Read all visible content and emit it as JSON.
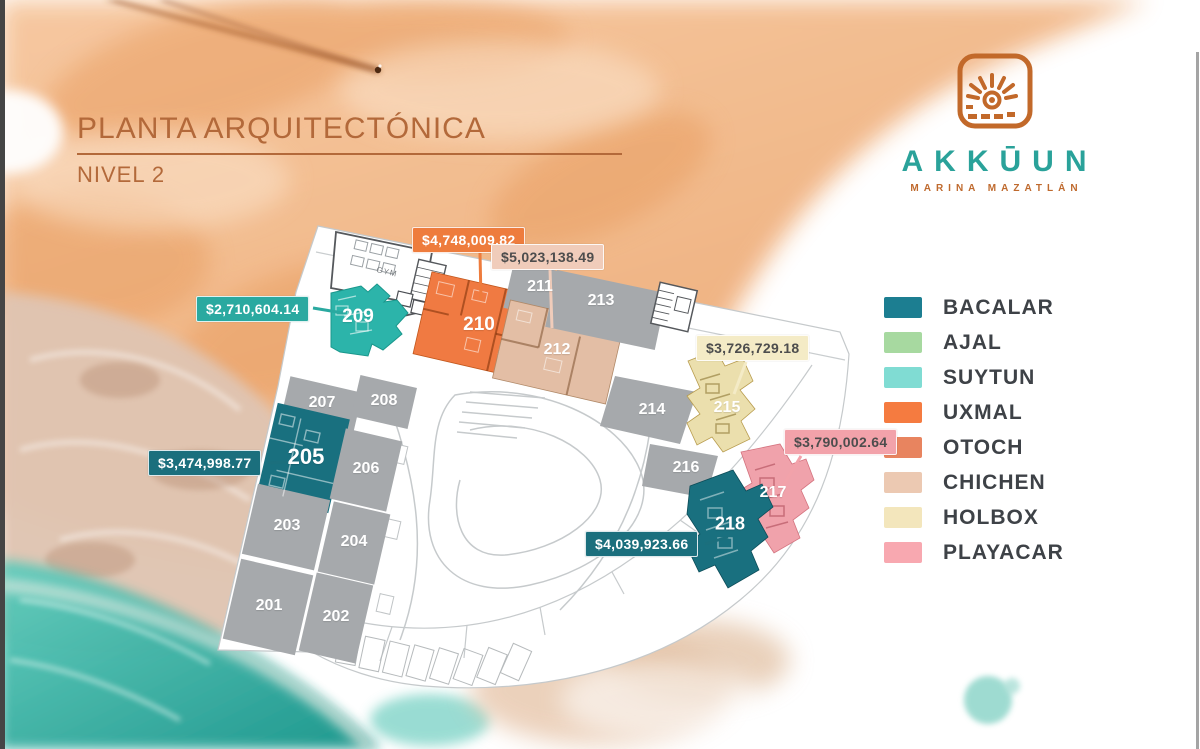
{
  "header": {
    "title": "PLANTA ARQUITECTÓNICA",
    "subtitle": "NIVEL 2"
  },
  "logo": {
    "brand": "AKKŪUN",
    "tagline": "MARINA MAZATLÁN"
  },
  "legend": {
    "items": [
      {
        "label": "BACALAR",
        "color": "#1c7e91"
      },
      {
        "label": "AJAL",
        "color": "#a7d9a0"
      },
      {
        "label": "SUYTUN",
        "color": "#80dcd3"
      },
      {
        "label": "UXMAL",
        "color": "#f57b40"
      },
      {
        "label": "OTOCH",
        "color": "#e8845f"
      },
      {
        "label": "CHICHEN",
        "color": "#ecc9b2"
      },
      {
        "label": "HOLBOX",
        "color": "#f3e6bc"
      },
      {
        "label": "PLAYACAR",
        "color": "#f8a8b0"
      }
    ]
  },
  "plan": {
    "gym_label": "GYM",
    "units": [
      {
        "number": "201",
        "color": "#a6a9ac"
      },
      {
        "number": "202",
        "color": "#a6a9ac"
      },
      {
        "number": "203",
        "color": "#a6a9ac"
      },
      {
        "number": "204",
        "color": "#a6a9ac"
      },
      {
        "number": "205",
        "color": "#19707f"
      },
      {
        "number": "206",
        "color": "#a6a9ac"
      },
      {
        "number": "207",
        "color": "#a6a9ac"
      },
      {
        "number": "208",
        "color": "#a6a9ac"
      },
      {
        "number": "209",
        "color": "#2cb4aa"
      },
      {
        "number": "210",
        "color": "#f07a42"
      },
      {
        "number": "211",
        "color": "#a6a9ac"
      },
      {
        "number": "212",
        "color": "#e3bea5"
      },
      {
        "number": "213",
        "color": "#a6a9ac"
      },
      {
        "number": "214",
        "color": "#a6a9ac"
      },
      {
        "number": "215",
        "color": "#ebdfad"
      },
      {
        "number": "216",
        "color": "#a6a9ac"
      },
      {
        "number": "217",
        "color": "#f0a2ab"
      },
      {
        "number": "218",
        "color": "#19707f"
      }
    ]
  },
  "price_labels": [
    {
      "text": "$4,748,009.82",
      "bg": "#ee7c3d",
      "fg": "#ffffff"
    },
    {
      "text": "$5,023,138.49",
      "bg": "#f0ccba",
      "fg": "#4d4d4d"
    },
    {
      "text": "$2,710,604.14",
      "bg": "#2aa9a0",
      "fg": "#ffffff"
    },
    {
      "text": "$3,726,729.18",
      "bg": "#f4ebc6",
      "fg": "#4d4d4d"
    },
    {
      "text": "$3,790,002.64",
      "bg": "#f2a2aa",
      "fg": "#4d4d4d"
    },
    {
      "text": "$3,474,998.77",
      "bg": "#1b6f7d",
      "fg": "#ffffff"
    },
    {
      "text": "$4,039,923.66",
      "bg": "#1b6f7d",
      "fg": "#ffffff"
    }
  ]
}
